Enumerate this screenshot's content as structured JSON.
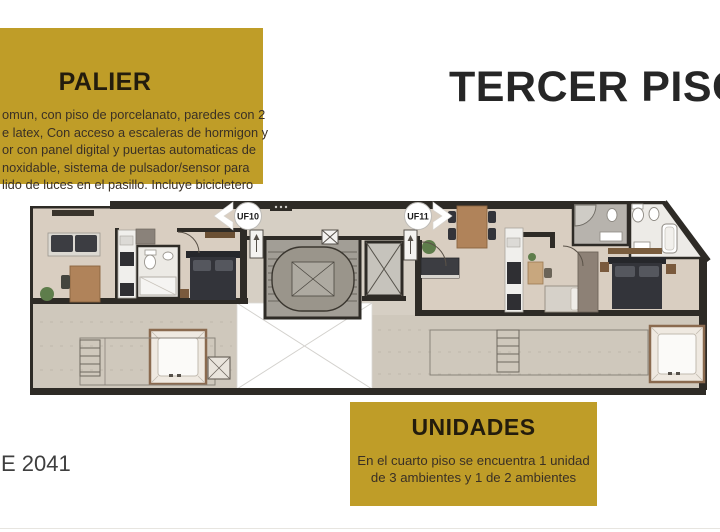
{
  "palier_box": {
    "title": "PALIER",
    "lines": [
      "omun, con piso de porcelanato, paredes con 2",
      "e latex, Con acceso a escaleras de hormigon y",
      "or con panel digital y puertas automaticas de",
      "noxidable, sistema de pulsador/sensor para",
      "lido de luces en el pasillo. Incluye bicicletero"
    ]
  },
  "floor_title": "TERCER PISO",
  "unidades_box": {
    "title": "UNIDADES",
    "lines": [
      "En el cuarto piso se encuentra 1 unidad",
      "de 3 ambientes y 1 de 2 ambientes"
    ]
  },
  "bottom_left_text": "E 2041",
  "plan": {
    "labels": {
      "uf10": "UF10",
      "uf11": "UF11"
    }
  },
  "colors": {
    "gold": "#bf9d28",
    "box_title_text": "#231c0d",
    "box_body_text": "#3a3025",
    "headline_text": "#262626",
    "wall": "#2e2b26",
    "unit_floor": "#d9cec1",
    "terrace_floor": "#cfc8bc",
    "stair_floor": "#a29e96",
    "furniture_dark": "#33343a",
    "furniture_wood": "#b0835a"
  }
}
